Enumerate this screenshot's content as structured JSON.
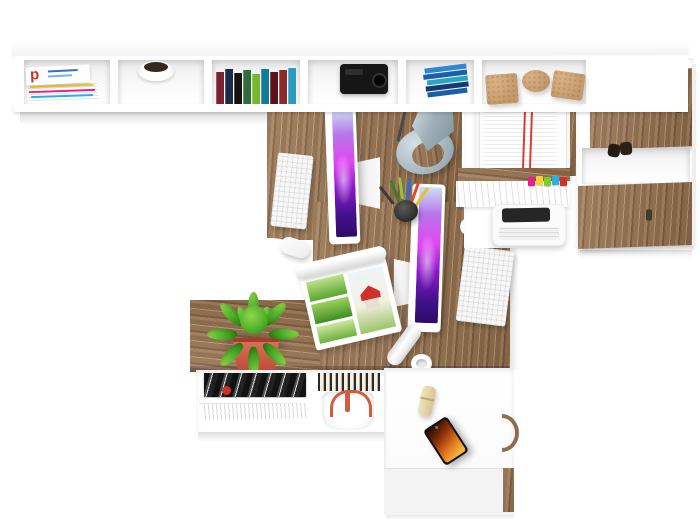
{
  "scene": {
    "description": "Top-down render of a white and oak home office with two facing workstations",
    "view": "top-down"
  },
  "magazine_cover": {
    "logo_letter": "p"
  },
  "colors": {
    "wood1": "#8f6c4b",
    "wood2": "#a5815c",
    "wood3": "#7d5c3e",
    "wood4": "#96734f",
    "woodLight": "#c29a6f",
    "woodDark": "#6b4d33",
    "white": "#ffffff",
    "offwhite": "#f4f4f4",
    "floor": "#fdfdfd",
    "screenTop": "#cfe0f2",
    "screenA": "#b678e8",
    "screenB": "#e145f2",
    "screenC": "#8a18c9",
    "screenD": "#45128e",
    "screenE": "#2d0a66",
    "lamp": "#9fb0ba",
    "lampLight": "#d6e0e4",
    "lampDark": "#7e929c",
    "green1": "#4db028",
    "green2": "#2e7d12",
    "green3": "#8fd64a",
    "pot": "#c14b38",
    "potLight": "#d8775c",
    "potRim": "#a93b2a",
    "cork": "#c59a6b",
    "corkDark": "#a87f4f",
    "copper": "#cf5f3c",
    "flameA": "#f6b23e",
    "flameB": "#e0751f",
    "flameC": "#8a2f08",
    "flameD": "#1a0a04",
    "red": "#d03028",
    "yellow": "#f3d32a",
    "pink": "#e91e8c",
    "blue": "#2ab0e8",
    "violet": "#9a53d6",
    "limegr": "#7ec832",
    "book1": "#7a2230",
    "book2": "#1b2a4a",
    "book3": "#151210",
    "book4": "#2f6e3a",
    "book5": "#79b82c",
    "book6": "#0f7d99",
    "book7": "#5d1118",
    "book8": "#8a2a2a",
    "book9": "#2a9dbf",
    "cd1": "#2f86d6",
    "cd2": "#1b5fa8",
    "cd3": "#123c6e",
    "cd4": "#2aa3c9",
    "pen1": "#3a7d2a",
    "pen2": "#8fc93a",
    "pen3": "#2a6fd6",
    "pen4": "#e04a2a",
    "pen5": "#e8c22e",
    "pen6": "#3a3a3a",
    "dark": "#1d1d1d"
  },
  "furniture": [
    {
      "name": "wall-shelf",
      "label": "wall shelf with six cubbies"
    },
    {
      "name": "right-cabinet",
      "label": "cabinet with two oak doors and open shelf"
    },
    {
      "name": "shelf-column",
      "label": "white shelf column with tray and printer"
    },
    {
      "name": "desk",
      "label": "oak double workstation desk with chair cutouts"
    },
    {
      "name": "plant-shelf",
      "label": "low oak shelf with cactus"
    },
    {
      "name": "magazine-shelf",
      "label": "white shelf with magazines and basket"
    },
    {
      "name": "bottom-desk",
      "label": "white desk with oak trim"
    }
  ],
  "items": [
    {
      "name": "magazine-stack",
      "label": "stack of magazines"
    },
    {
      "name": "bowl",
      "label": "bowl with dark interior"
    },
    {
      "name": "book-row",
      "label": "row of books"
    },
    {
      "name": "black-camera",
      "label": "black device"
    },
    {
      "name": "cd-stack",
      "label": "stack of blue cases"
    },
    {
      "name": "cork-blocks",
      "label": "cork blocks and disk"
    },
    {
      "name": "desk-lamp",
      "label": "grey metal desk lamp"
    },
    {
      "name": "paper-tray",
      "label": "wire tray with documents"
    },
    {
      "name": "tabbed-papers",
      "label": "paper stack with colored index tabs"
    },
    {
      "name": "printer",
      "label": "white printer"
    },
    {
      "name": "folded-glasses",
      "label": "dark folded object"
    },
    {
      "name": "monitor-1",
      "label": "all-in-one monitor, purple wallpaper"
    },
    {
      "name": "monitor-2",
      "label": "all-in-one monitor, purple wallpaper"
    },
    {
      "name": "keyboard-1",
      "label": "white keyboard"
    },
    {
      "name": "keyboard-2",
      "label": "white keyboard"
    },
    {
      "name": "mouse-1",
      "label": "white mouse"
    },
    {
      "name": "mouse-2",
      "label": "white mouse"
    },
    {
      "name": "pen-cup",
      "label": "pen cup with colored pencils"
    },
    {
      "name": "open-magazine",
      "label": "open magazine with house photos"
    },
    {
      "name": "paper-roll",
      "label": "rolled document"
    },
    {
      "name": "cactus",
      "label": "cactus in red pot"
    },
    {
      "name": "mug",
      "label": "white mug"
    },
    {
      "name": "magazine-pile",
      "label": "pile of black and white magazines"
    },
    {
      "name": "fanned-papers",
      "label": "fanned white papers"
    },
    {
      "name": "striped-magazines",
      "label": "upright striped magazines"
    },
    {
      "name": "basket",
      "label": "white basket with copper handles"
    },
    {
      "name": "usb-stick",
      "label": "wooden usb stick"
    },
    {
      "name": "phone",
      "label": "smartphone with fiery wallpaper"
    },
    {
      "name": "door-handle",
      "label": "curved oak handle"
    }
  ]
}
